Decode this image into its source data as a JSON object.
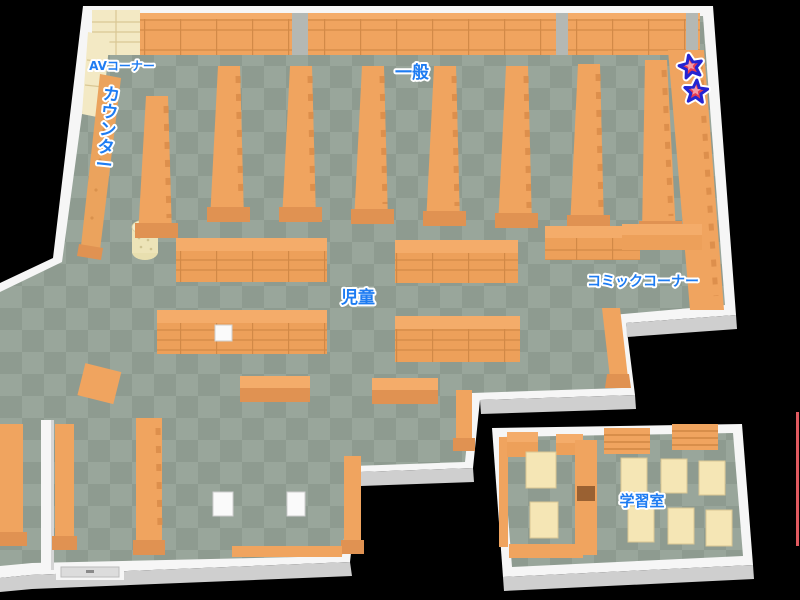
{
  "map": {
    "type": "library-floor-map",
    "labels": {
      "av_corner": "AVコーナー",
      "general": "一般",
      "counter": "カウンター",
      "children": "児童",
      "comic_corner": "コミックコーナー",
      "study_room": "学習室"
    },
    "markers": {
      "stars": [
        {
          "shape": "star",
          "x": 691,
          "y": 67
        },
        {
          "shape": "star",
          "x": 696,
          "y": 92
        }
      ]
    }
  },
  "colors": {
    "background": "#000000",
    "floor_light": "#99A69B",
    "floor_dark": "#8E9B90",
    "shelf": "#F0A45F",
    "shelf_top": "#F4AC6A",
    "shelf_front": "#EDA05A",
    "shelf_line": "#C9813F",
    "shelf_dark": "#DD8F4C",
    "shelf_foot": "#E09252",
    "counter": "#EBA35D",
    "cream": "#F3E9C4",
    "cream_dark": "#D9C794",
    "desk": "#F5E6B5",
    "wall": "#F6F6F6",
    "wall_shade": "#CFCFCF",
    "wall_gap": "#B4B8B4",
    "label_blue": "#1E7CF2",
    "label_outline": "#FFFFFF",
    "star_fill": "#E73B52",
    "star_highlight": "#F59AA6",
    "star_stroke": "#2424D2",
    "star_halo": "#FFFFFF",
    "stool": "#FAFAFA",
    "door_glass": "#DCDCDC",
    "divider_door": "#9A6132",
    "accent_line": "#E15A60"
  }
}
